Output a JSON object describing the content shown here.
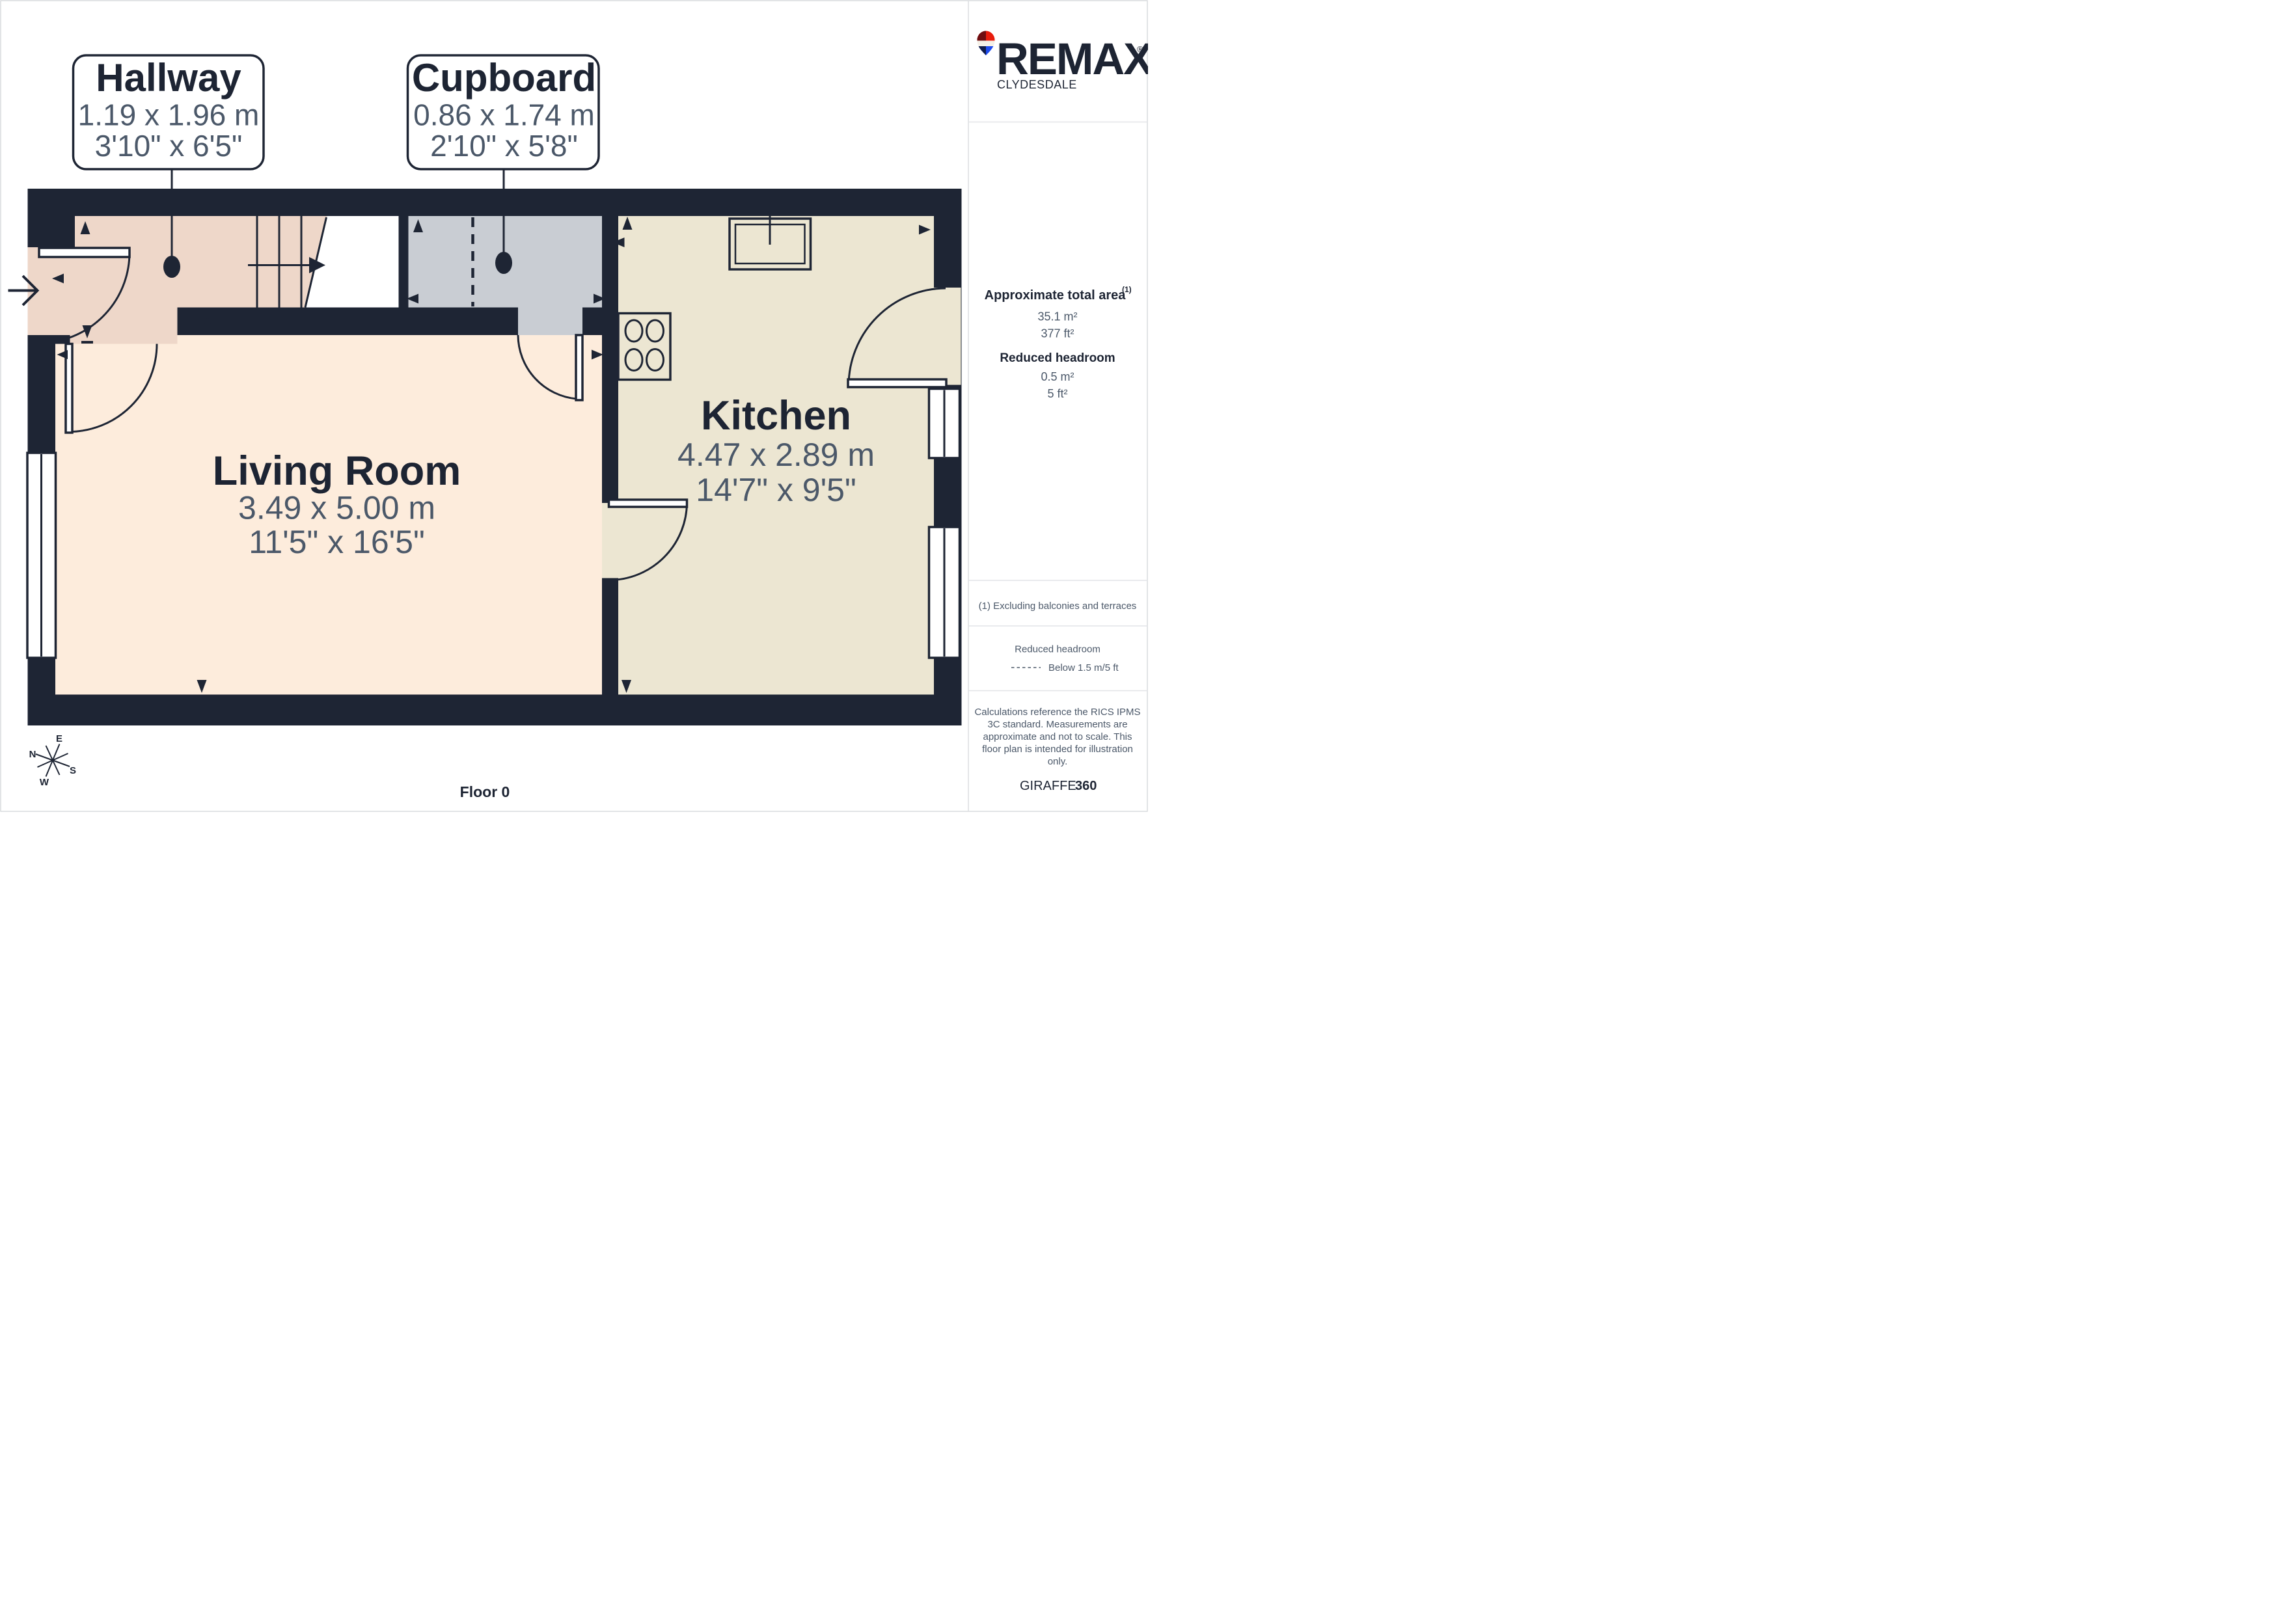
{
  "floorplan": {
    "floor_label": "Floor 0",
    "rooms": [
      {
        "name": "Hallway",
        "dim_m": "1.19 x 1.96 m",
        "dim_ft": "3'10\" x 6'5\""
      },
      {
        "name": "Cupboard",
        "dim_m": "0.86 x 1.74 m",
        "dim_ft": "2'10\" x 5'8\""
      },
      {
        "name": "Living Room",
        "dim_m": "3.49 x 5.00 m",
        "dim_ft": "11'5\" x 16'5\""
      },
      {
        "name": "Kitchen",
        "dim_m": "4.47 x 2.89 m",
        "dim_ft": "14'7\" x 9'5\""
      }
    ],
    "compass": {
      "n": "N",
      "e": "E",
      "s": "S",
      "w": "W"
    }
  },
  "sidebar": {
    "brand": {
      "name": "REMAX",
      "registered": "®",
      "sub": "CLYDESDALE"
    },
    "area": {
      "title": "Approximate total area",
      "sup": "(1)",
      "m2": "35.1 m²",
      "ft2": "377 ft²"
    },
    "reduced": {
      "title": "Reduced headroom",
      "m2": "0.5 m²",
      "ft2": "5 ft²"
    },
    "footnote": "(1) Excluding balconies and terraces",
    "legend": {
      "title": "Reduced headroom",
      "item": "Below 1.5 m/5 ft"
    },
    "disclaimer_lines": [
      "Calculations reference the RICS IPMS",
      "3C standard. Measurements are",
      "approximate and not to scale. This",
      "floor plan is intended for illustration",
      "only."
    ],
    "credit": {
      "brand": "GIRAFFE",
      "suffix": "360"
    }
  },
  "colors": {
    "wall": "#1e2534",
    "hallway": "#eed7c9",
    "living": "#fdecdc",
    "kitchen": "#ece6d2",
    "cupboard": "#c9cdd3",
    "text_dark": "#1d2433",
    "text_gray": "#4b5869",
    "divider": "#e2e4e7",
    "balloon_red": "#e81c0c",
    "balloon_dark_red": "#6f0d10",
    "balloon_blue": "#1e4bee",
    "balloon_navy": "#101c49"
  }
}
